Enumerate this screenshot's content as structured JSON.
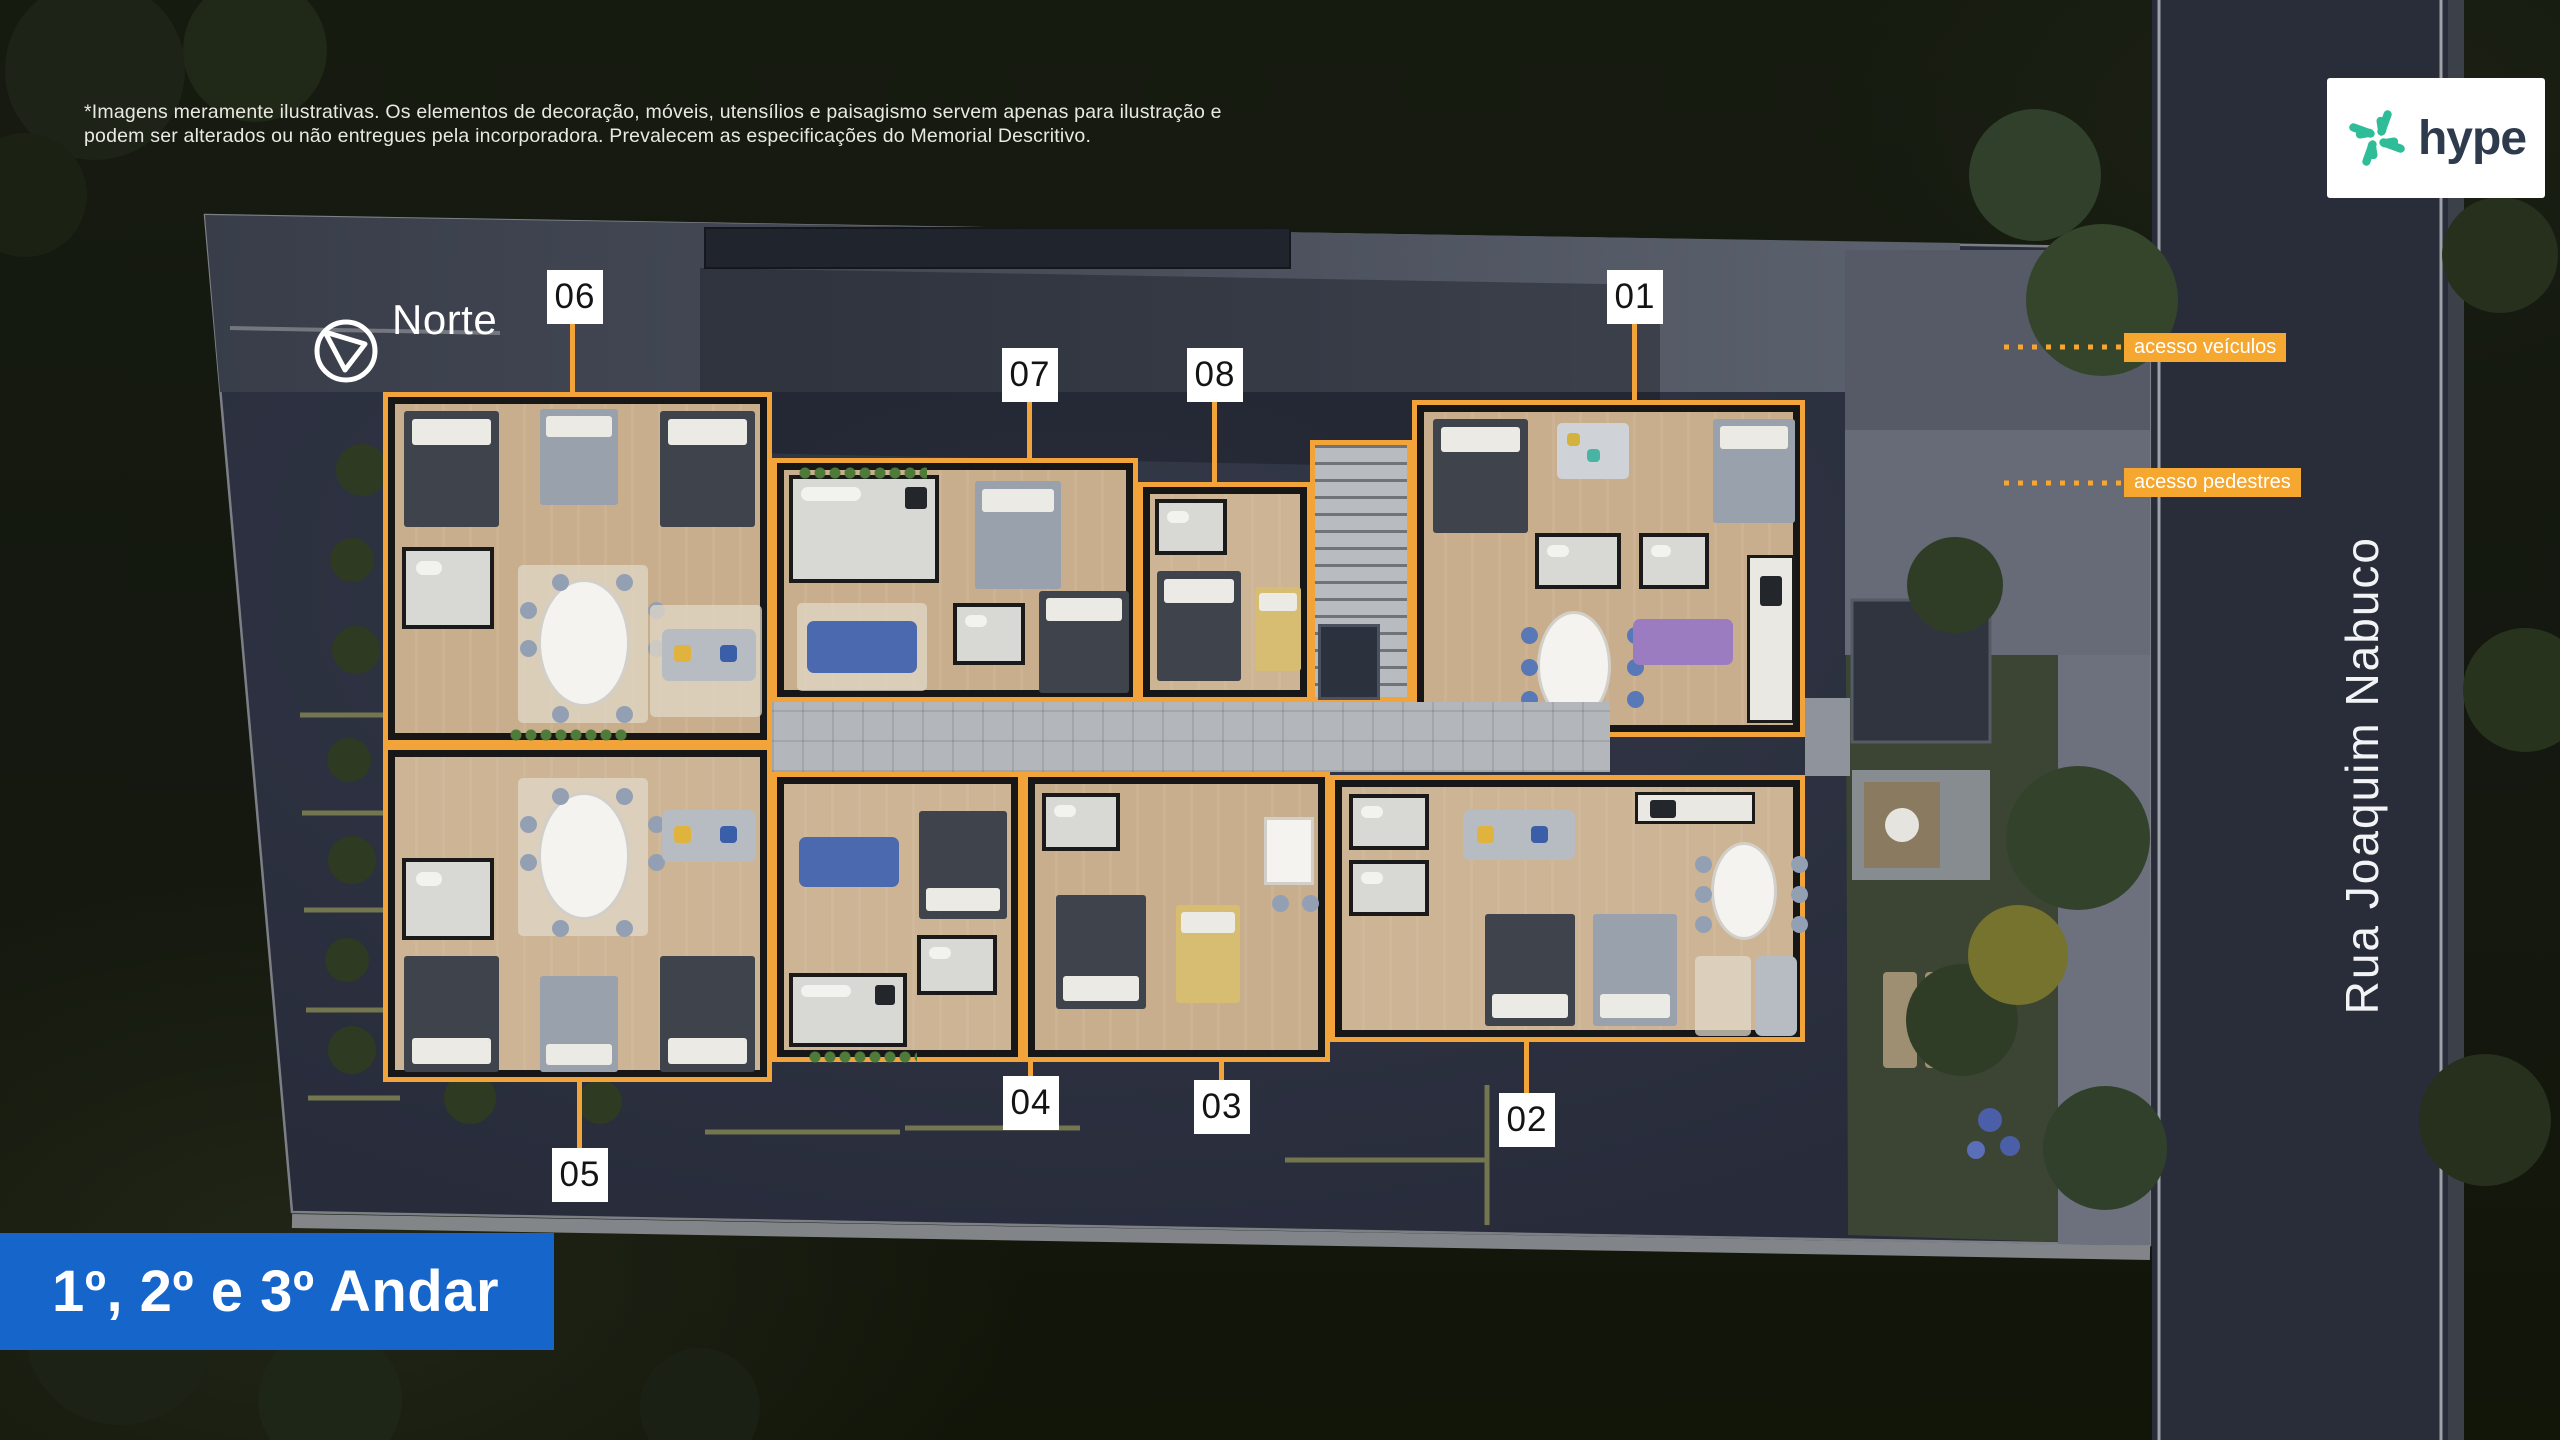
{
  "disclaimer": {
    "line1": "*Imagens meramente ilustrativas. Os elementos de decoração, móveis, utensílios e paisagismo servem apenas para ilustração e",
    "line2": "podem ser alterados ou não entregues pela incorporadora. Prevalecem as especificações do Memorial Descritivo."
  },
  "compass": {
    "label": "Norte"
  },
  "logo": {
    "brand": "hype"
  },
  "street": {
    "name": "Rua Joaquim Nabuco"
  },
  "floor_banner": {
    "title": "1º, 2º e 3º Andar"
  },
  "access_labels": {
    "vehicles": "acesso veículos",
    "pedestrians": "acesso pedestres"
  },
  "units": [
    {
      "label": "01"
    },
    {
      "label": "02"
    },
    {
      "label": "03"
    },
    {
      "label": "04"
    },
    {
      "label": "05"
    },
    {
      "label": "06"
    },
    {
      "label": "07"
    },
    {
      "label": "08"
    }
  ],
  "colors": {
    "accent_orange": "#F2A43B",
    "label_orange": "#F5A730",
    "banner_blue": "#1565CB",
    "logo_green": "#2EBD96",
    "logo_navy": "#2E3B4D"
  }
}
